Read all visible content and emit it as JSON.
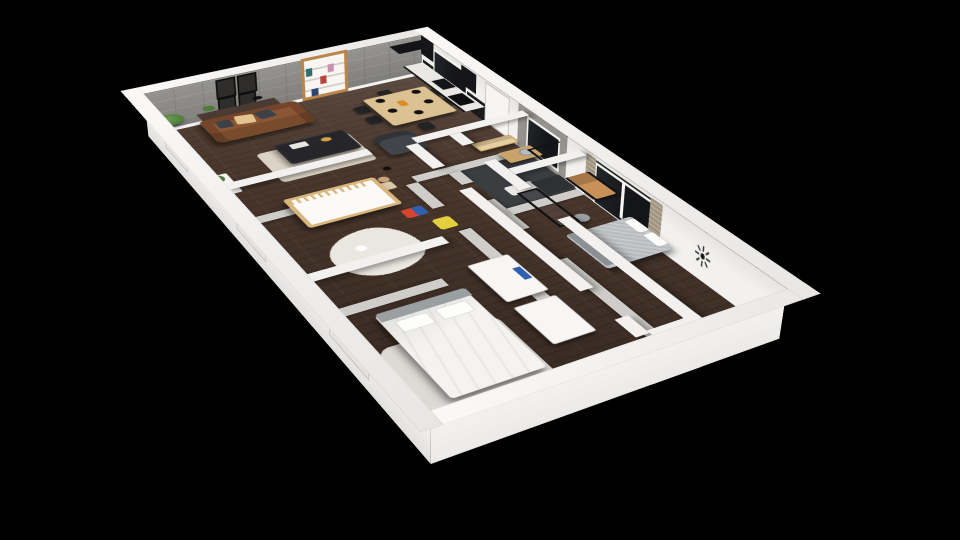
{
  "scene": {
    "type": "3d-floorplan-cutaway-render",
    "background": "#000000",
    "view": "isometric from above, rotated ~29 degrees",
    "label": "Apartment 3D floor plan render"
  },
  "colors": {
    "bg": "#000000",
    "wall": "#f2f1ef",
    "wallShade": "#dad8d4",
    "wallBase": "#cfcdc9",
    "accentWall": "#8f8e8a",
    "floorWood": "#4a372c",
    "bathFloor": "#3b3e41",
    "sofa": "#8a5634",
    "sofaDark": "#74452a",
    "cushionTan": "#e3c48f",
    "cushionGrey": "#3c4148",
    "woodLight": "#d9b57e",
    "woodMid": "#b98549",
    "tableWood": "#dcc292",
    "black": "#161618",
    "counter": "#e9e8e4",
    "bedGrey": "#b9bdc0",
    "bedWhite": "#f4f3f0",
    "headboard": "#9aa0a2",
    "curtain": "#b3a794",
    "rugCream": "#e7e1d2",
    "rugWhite": "#f3f1ea",
    "glass": "#141518",
    "plant": "#4e7d3a",
    "potGrey": "#9a9a9a",
    "toyYellow": "#e4cf3e",
    "toyRed": "#d5452f",
    "toyBlue": "#2e5fb0",
    "clock": "#111111",
    "sideboard": "#4a3a31",
    "loungeGrey": "#41454b",
    "ctable": "#26262a",
    "greyPatch": "#94938e",
    "doorWhite": "#f6f5f3"
  },
  "rooms": {
    "living_kitchen": {
      "label": "Open living / dining / kitchen",
      "furniture": [
        "grey stone accent wall",
        "4 black picture frames",
        "tall potted plant",
        "wood sideboard with plant and bowl",
        "brown leather sofa with tan and grey cushions",
        "cream rug",
        "dark coffee table with books and bowl",
        "grey lounge chair",
        "floor lamp",
        "wood bookshelf with colorful books",
        "light wood dining table",
        "6 black chairs",
        "5 black plates",
        "orange vase",
        "black fridge",
        "black kitchen counter with white top",
        "black sink",
        "black cooktop",
        "black range hood",
        "kitchen window"
      ]
    },
    "nursery": {
      "label": "Nursery",
      "furniture": [
        "light wood crib with white mattress",
        "white play rug",
        "red and blue toy",
        "yellow toy walker",
        "teddy bear on stool"
      ]
    },
    "bathroom": {
      "label": "Bathroom",
      "furniture": [
        "light wood cube shelf",
        "wood vanity with round basin",
        "white mat",
        "dark shower with black glass screen",
        "small window in concrete wall"
      ]
    },
    "master_bedroom": {
      "label": "Master bedroom",
      "furniture": [
        "wood ladder desk with black rails",
        "metal stool",
        "bed with grey textured blanket and white pillows",
        "window with beige curtains",
        "starburst wall clock",
        "black glass door frame"
      ]
    },
    "second_bedroom": {
      "label": "Second bedroom",
      "furniture": [
        "white bed with grey headboard and two pillows",
        "white rug",
        "two white closets",
        "blue book on shelf"
      ]
    },
    "hallway": {
      "label": "Hallway",
      "furniture": [
        "dark wood floor"
      ]
    }
  },
  "wall_features": {
    "entry_door": "white entry door on upper-right wall",
    "windows": [
      "kitchen window",
      "bathroom window in grey concrete patch",
      "master bedroom double window with curtains",
      "three recessed windows on lower-left exterior wall"
    ],
    "clock": "black starburst clock",
    "frames_count": "4"
  }
}
